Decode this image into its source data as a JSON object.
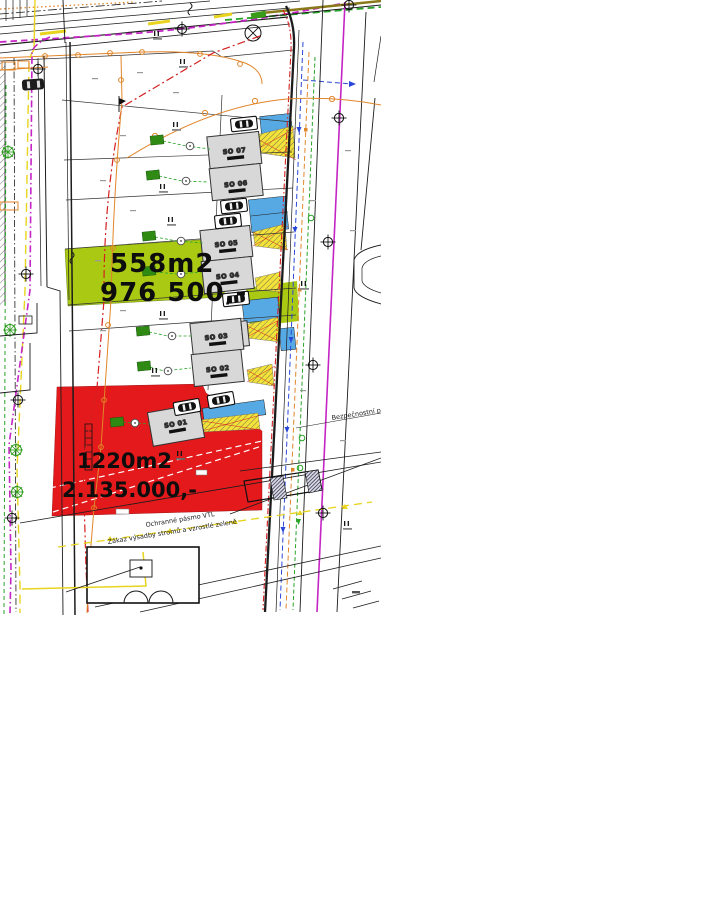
{
  "map": {
    "buildings": [
      {
        "label": "SO 07"
      },
      {
        "label": "SO 06"
      },
      {
        "label": "SO 05"
      },
      {
        "label": "SO 04"
      },
      {
        "label": "SO 03"
      },
      {
        "label": "SO 02"
      },
      {
        "label": "SO 01"
      }
    ],
    "green_plot": {
      "area": "558m2",
      "price": "976 500,-"
    },
    "red_plot": {
      "area": "1220m2",
      "price": "2.135.000,-"
    },
    "annotations": {
      "protection_zone": "Ochranné pásmo VTL",
      "planting_ban": "Zákaz výsadby stromů a vzrostlé zeleně",
      "safety_zone": "Bezpečnostní pá"
    },
    "symbols": {
      "pole": "II"
    },
    "colors": {
      "green_plot": "#a9c913",
      "red_plot": "#e4191b",
      "parking_blue": "#57a9e3",
      "building_gray": "#d8d8d8",
      "hatch_yellow": "#f2e23a",
      "utility_orange": "#e0862a",
      "utility_magenta": "#c524c5",
      "tree_green": "#2e8a12"
    }
  }
}
